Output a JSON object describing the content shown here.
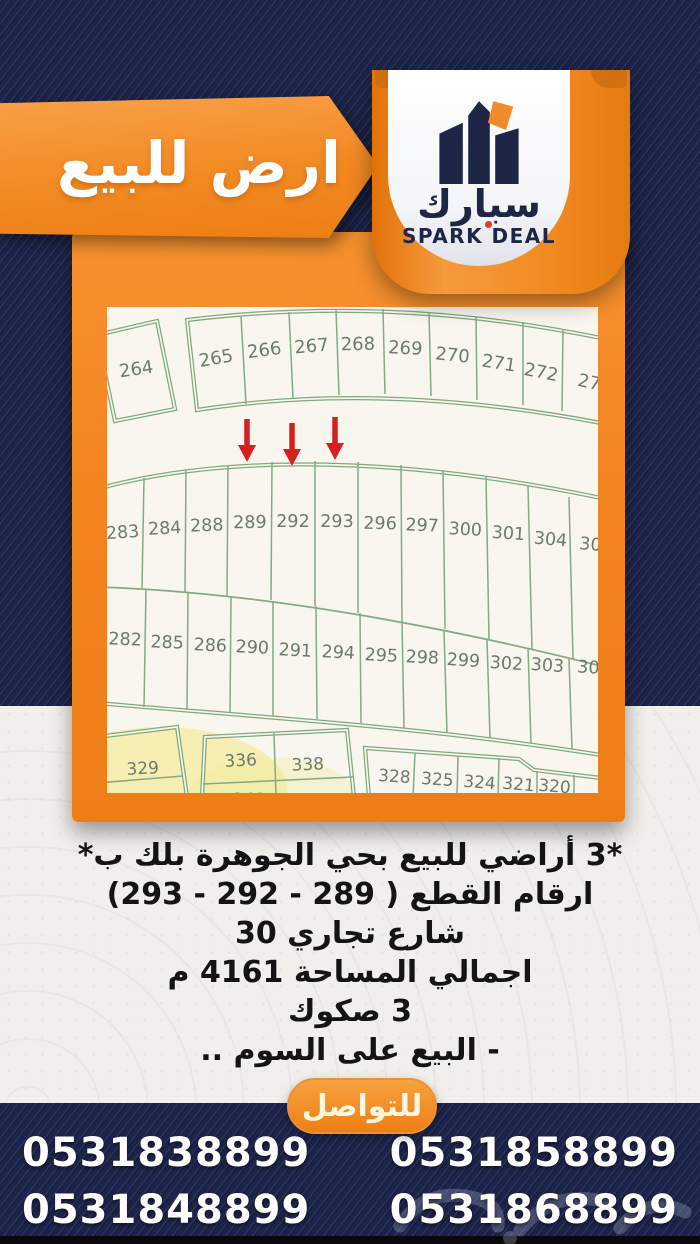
{
  "banner": {
    "title": "ارض للبيع"
  },
  "brand": {
    "logo": "building-icon",
    "name_ar": "سبارك",
    "name_en": "SPARK DEAL"
  },
  "map": {
    "top_left": {
      "plot": "264",
      "partial": "3"
    },
    "top_arc": {
      "plots": [
        "265",
        "266",
        "267",
        "268",
        "269",
        "270",
        "271",
        "272"
      ],
      "partial": "27"
    },
    "row_upper": {
      "plots": [
        "283",
        "284",
        "288",
        "289",
        "292",
        "293",
        "296",
        "297",
        "300",
        "301",
        "304"
      ],
      "partial": "30"
    },
    "row_lower": {
      "plots": [
        "282",
        "285",
        "286",
        "290",
        "291",
        "294",
        "295",
        "298",
        "299",
        "302",
        "303"
      ],
      "partial": "30"
    },
    "bottom_left": {
      "plot": "329"
    },
    "bottom_middle": {
      "plots": [
        "336",
        "338"
      ],
      "partials": [
        "340",
        "339"
      ]
    },
    "bottom_right": {
      "plots": [
        "328",
        "325",
        "324",
        "321",
        "320"
      ]
    },
    "highlighted_plots": [
      "289",
      "292",
      "293"
    ],
    "colors": {
      "lines": "#7fa87f",
      "numbers": "#6b7c6b",
      "arrow": "#d81f1f",
      "paper": "#f8f6ee"
    }
  },
  "details": {
    "lines": [
      "*3 أراضي للبيع بحي الجوهرة بلك ب*",
      "ارقام القطع (  289 - 292 - 293)",
      "شارع تجاري 30",
      "اجمالي المساحة 4161 م",
      "3 صكوك",
      "- البيع على السوم .."
    ]
  },
  "contact": {
    "button_label": "للتواصل",
    "phone_rows": [
      [
        "0531838899",
        "0531858899"
      ],
      [
        "0531848899",
        "0531868899"
      ]
    ]
  },
  "colors": {
    "navy": "#1d2449",
    "orange": "#f28420",
    "orange_light": "#f9a04a",
    "black_strip": "#0a0a0c"
  }
}
